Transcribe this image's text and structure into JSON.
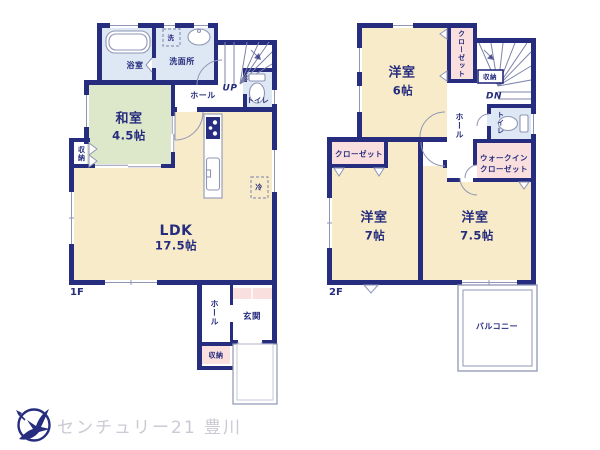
{
  "colors": {
    "navy": "#262c7e",
    "cream": "#f8ebc9",
    "green": "#dde8cb",
    "blue": "#dee7f4",
    "pink": "#f9dfdd",
    "line": "#8f96b4",
    "logo-gray": "#c9cad3"
  },
  "floor1": {
    "label": "1F",
    "bathroom": "浴室",
    "laundry": "洗",
    "washroom": "洗面所",
    "hall_upper": "ホール",
    "stairs_up": "UP",
    "toilet": "トイレ",
    "japanese_room": {
      "name": "和室",
      "size": "4.5帖"
    },
    "storage_left": "収納",
    "ldk": {
      "name": "LDK",
      "size": "17.5帖"
    },
    "fridge": "冷",
    "hall_lower": "ホール",
    "entrance": "玄関",
    "storage_lower": "収納"
  },
  "floor2": {
    "label": "2F",
    "room6": {
      "name": "洋室",
      "size": "6帖"
    },
    "closet_upper": "クローゼット",
    "storage": "収納",
    "stairs_down": "DN",
    "hall": "ホール",
    "toilet": "トイレ",
    "walkin_closet": {
      "line1": "ウォークイン",
      "line2": "クローゼット"
    },
    "closet_left": "クローゼット",
    "room7": {
      "name": "洋室",
      "size": "7帖"
    },
    "room75": {
      "name": "洋室",
      "size": "7.5帖"
    },
    "balcony": "バルコニー"
  },
  "branding": {
    "company": "センチュリー21 豊川",
    "logo_icon": "compass-bird-icon"
  }
}
